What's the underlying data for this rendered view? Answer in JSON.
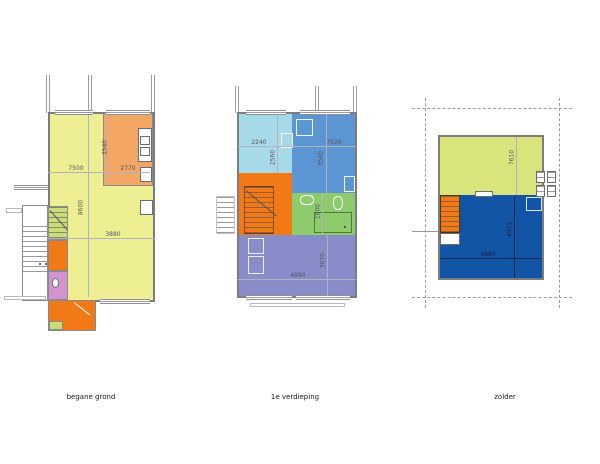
{
  "sheet": {
    "type": "architectural-floorplan-set",
    "background": "#ffffff"
  },
  "palette": {
    "living_yellow": "#eeee93",
    "kitchen_orange": "#f4a765",
    "hall_orange": "#f17a16",
    "toilet_pink": "#d194d1",
    "stair_green": "#cbdc79",
    "bedroom_cyan": "#a6dae8",
    "bedroom_blue": "#5c95d4",
    "bathroom_green": "#8ecb6d",
    "bedroom_purple": "#888cc8",
    "attic_yellowgreen": "#dae47d",
    "attic_blue": "#1254a5",
    "wall_gray": "#7d7d7d"
  },
  "plans": [
    {
      "id": "begane-grond",
      "label": "begane grond",
      "dims": [
        "7500",
        "2770",
        "3540",
        "8600",
        "3880"
      ]
    },
    {
      "id": "1e-verdieping",
      "label": "1e verdieping",
      "dims": [
        "2240",
        "7520",
        "2560",
        "3540",
        "1800",
        "4880",
        "3070"
      ]
    },
    {
      "id": "zolder",
      "label": "zolder",
      "dims": [
        "7610",
        "4951",
        "4880"
      ]
    }
  ]
}
